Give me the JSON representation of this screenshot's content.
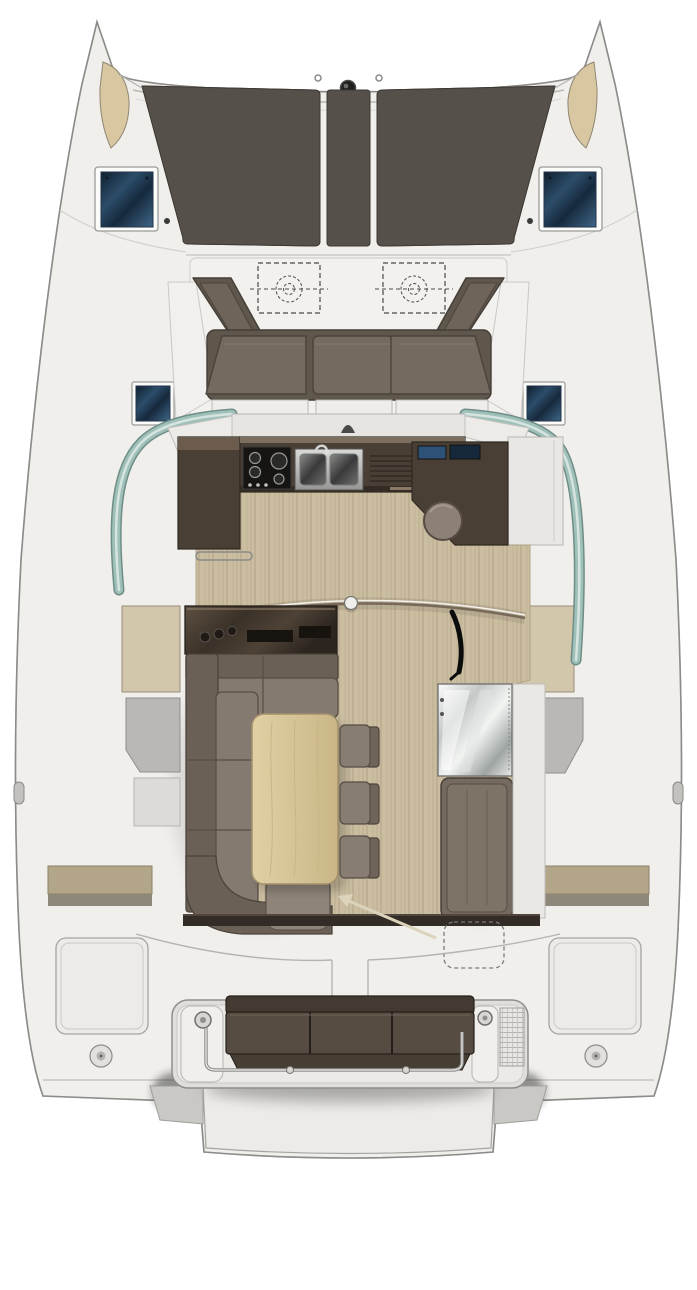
{
  "inventory": {
    "trampolines": 2,
    "bow_seats": 2,
    "foredeck_hatches": 2,
    "midship_hatches": 2,
    "forward_bench_cushions": 3,
    "escape_hatches_dashed": 2,
    "stove_burners": 4,
    "sink_basins": 2,
    "instrument_screens": 2,
    "bar_stool": 1,
    "dinette_chairs": 3,
    "dining_table": 1,
    "sofa_shape": "L",
    "chart_table": 1,
    "nav_bench": 1,
    "aft_bench_cushions": 3,
    "deck_fillers": 2,
    "aft_lockers": 2,
    "pod_fittings": 2,
    "cleats": 2
  },
  "colors": {
    "deck": "#f0efec",
    "deck_recess": "#f2f1ee",
    "outline": "#8b8b89",
    "trampoline": "#56504a",
    "bow_seat": "#d8c7a0",
    "hatch_frame": "#fbfbfa",
    "bench_back": "#5f564c",
    "bench_wing_cushion": "#6e645a",
    "bench_cushion": "#746a60",
    "galley_cabinet": "#4a3f35",
    "stove": "#171513",
    "glass": "#9fc0b9",
    "wood_floor": "#cbbda0",
    "sideboard": "#3f362c",
    "sofa_back": "#6b6055",
    "sofa_seat": "#847a6f",
    "ottoman": "#8e8479",
    "chair_seat": "#877d72",
    "chair_back": "#6e645a",
    "stool": "#8d8177",
    "nav_bench": "#746a5f",
    "nav_cushion": "#7d7367",
    "beige_panel": "#d2c7ab",
    "gray_locker": "#b9b8b4",
    "olive_step": "#b2a588",
    "olive_step_dark": "#8e887a",
    "aft_wall": "#332c26",
    "aft_bench_back": "#433a31",
    "aft_bench_seat": "#564c41",
    "aft_bench_lip": "#463d33",
    "arrow": "#dcd3bd",
    "white_trim": "#ecebe8",
    "platform": "#e0deda",
    "hatch_dot": "#3a3a38",
    "table_stroke": "#a3906c"
  }
}
